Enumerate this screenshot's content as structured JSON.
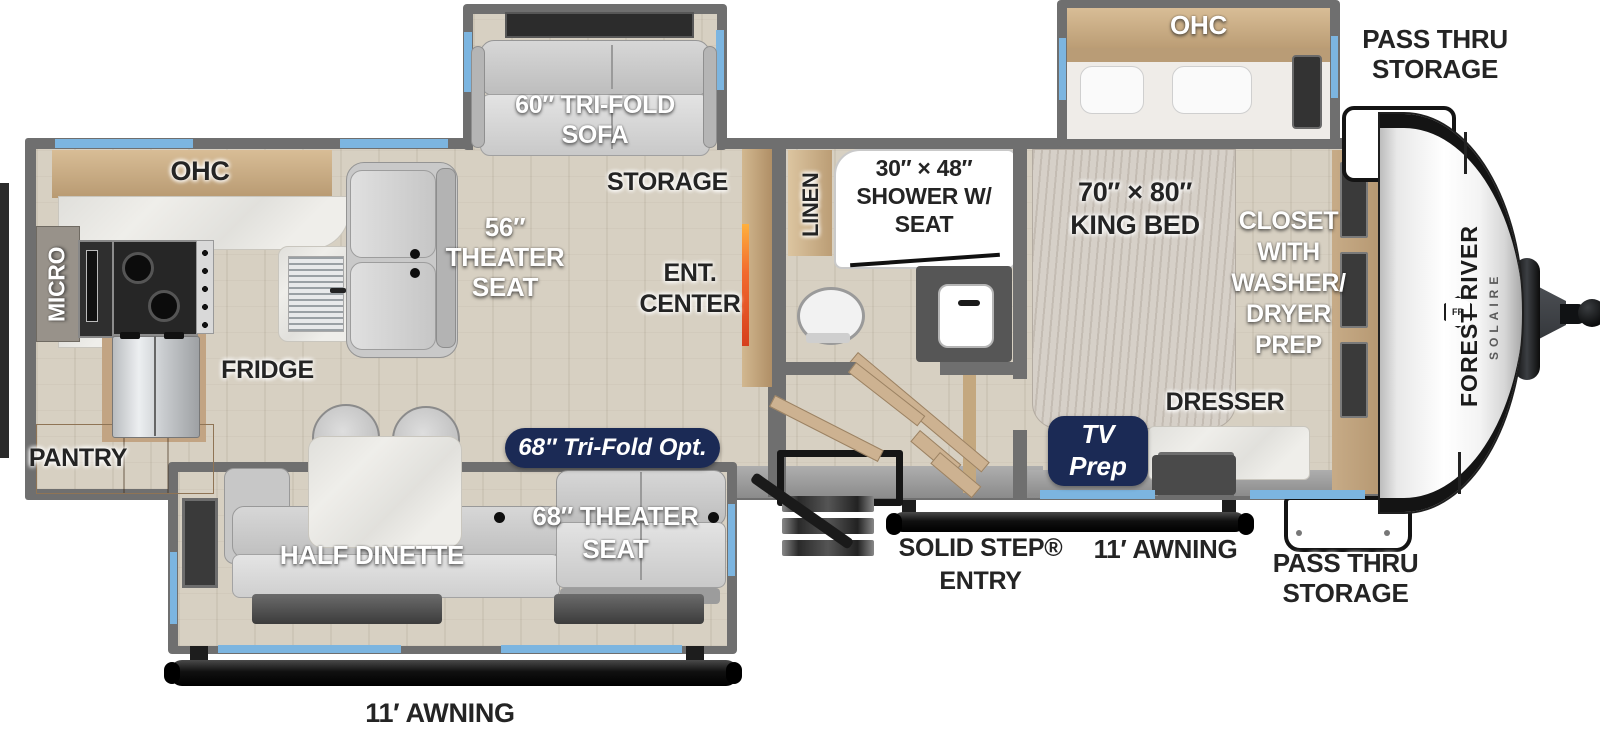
{
  "meta": {
    "diagram_type": "RV travel trailer floor plan"
  },
  "colors": {
    "wall": "#6f6f6f",
    "window_blue": "#7cb5e0",
    "floor_wood": "#d7d0c2",
    "cabinet_wood": "#c2a483",
    "marble": "#efeeea",
    "fabric": "#cfcfcf",
    "badge_navy": "#1b2a55",
    "fireplace_orange": "#f26a2e",
    "label_dark": "#242424",
    "label_white": "#ffffff"
  },
  "kitchen": {
    "ohc": "OHC",
    "micro": "MICRO",
    "fridge": "FRIDGE",
    "pantry": "PANTRY"
  },
  "living": {
    "theater_seat": {
      "line1": "56″",
      "line2": "THEATER",
      "line3": "SEAT"
    },
    "ent_center": {
      "line1": "ENT.",
      "line2": "CENTER"
    },
    "storage": "STORAGE",
    "sofa": {
      "line1": "60″ TRI-FOLD",
      "line2": "SOFA"
    },
    "tri_fold_option": "68″ Tri-Fold Opt."
  },
  "dinette": {
    "half_dinette": "HALF DINETTE",
    "theater_seat": {
      "line1": "68″ THEATER",
      "line2": "SEAT"
    },
    "awning": "11′ AWNING"
  },
  "bathroom": {
    "linen": "LINEN",
    "shower": {
      "line1": "30″ × 48″",
      "line2": "SHOWER W/",
      "line3": "SEAT"
    }
  },
  "bedroom": {
    "ohc": "OHC",
    "king_bed": {
      "line1": "70″ × 80″",
      "line2": "KING BED"
    },
    "closet": {
      "line1": "CLOSET",
      "line2": "WITH",
      "line3": "WASHER/",
      "line4": "DRYER",
      "line5": "PREP"
    },
    "dresser": "DRESSER",
    "tv_prep": {
      "line1": "TV",
      "line2": "Prep"
    }
  },
  "exterior": {
    "pass_thru_top": {
      "line1": "PASS THRU",
      "line2": "STORAGE"
    },
    "pass_thru_bottom": {
      "line1": "PASS THRU",
      "line2": "STORAGE"
    },
    "entry": {
      "line1": "SOLID STEP®",
      "line2": "ENTRY"
    },
    "door_side_awning": "11′ AWNING",
    "brand": "FOREST RIVER",
    "model": "SOLAIRE",
    "logo_monogram": "FR"
  }
}
